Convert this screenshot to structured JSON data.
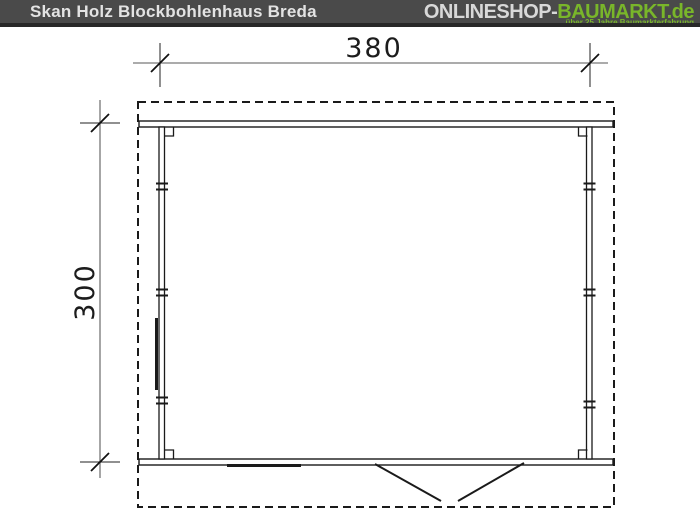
{
  "header": {
    "title": "Skan Holz Blockbohlenhaus Breda",
    "logo": {
      "part_gray": "ONLINESHOP-",
      "part_green": "BAUMARKT",
      "part_tld": ".de",
      "tagline": "über 25 Jahre Baumarkterfahrung"
    },
    "colors": {
      "bar_bg": "#4a4a4a",
      "bar_strip": "#282828",
      "title_text": "#e3e3e3",
      "logo_gray": "#d8d8d8",
      "logo_green": "#79b62a"
    }
  },
  "drawing": {
    "type": "floor-plan",
    "description": "Top view plan of log cabin with dashed roof outline, front/back beams, side walls, double-door swing at bottom and window marks on left and bottom walls",
    "dimensions": {
      "width_label": "380",
      "depth_label": "300"
    },
    "colors": {
      "outline": "#1a1a1a",
      "dimension_line": "#8f8f8f"
    }
  }
}
